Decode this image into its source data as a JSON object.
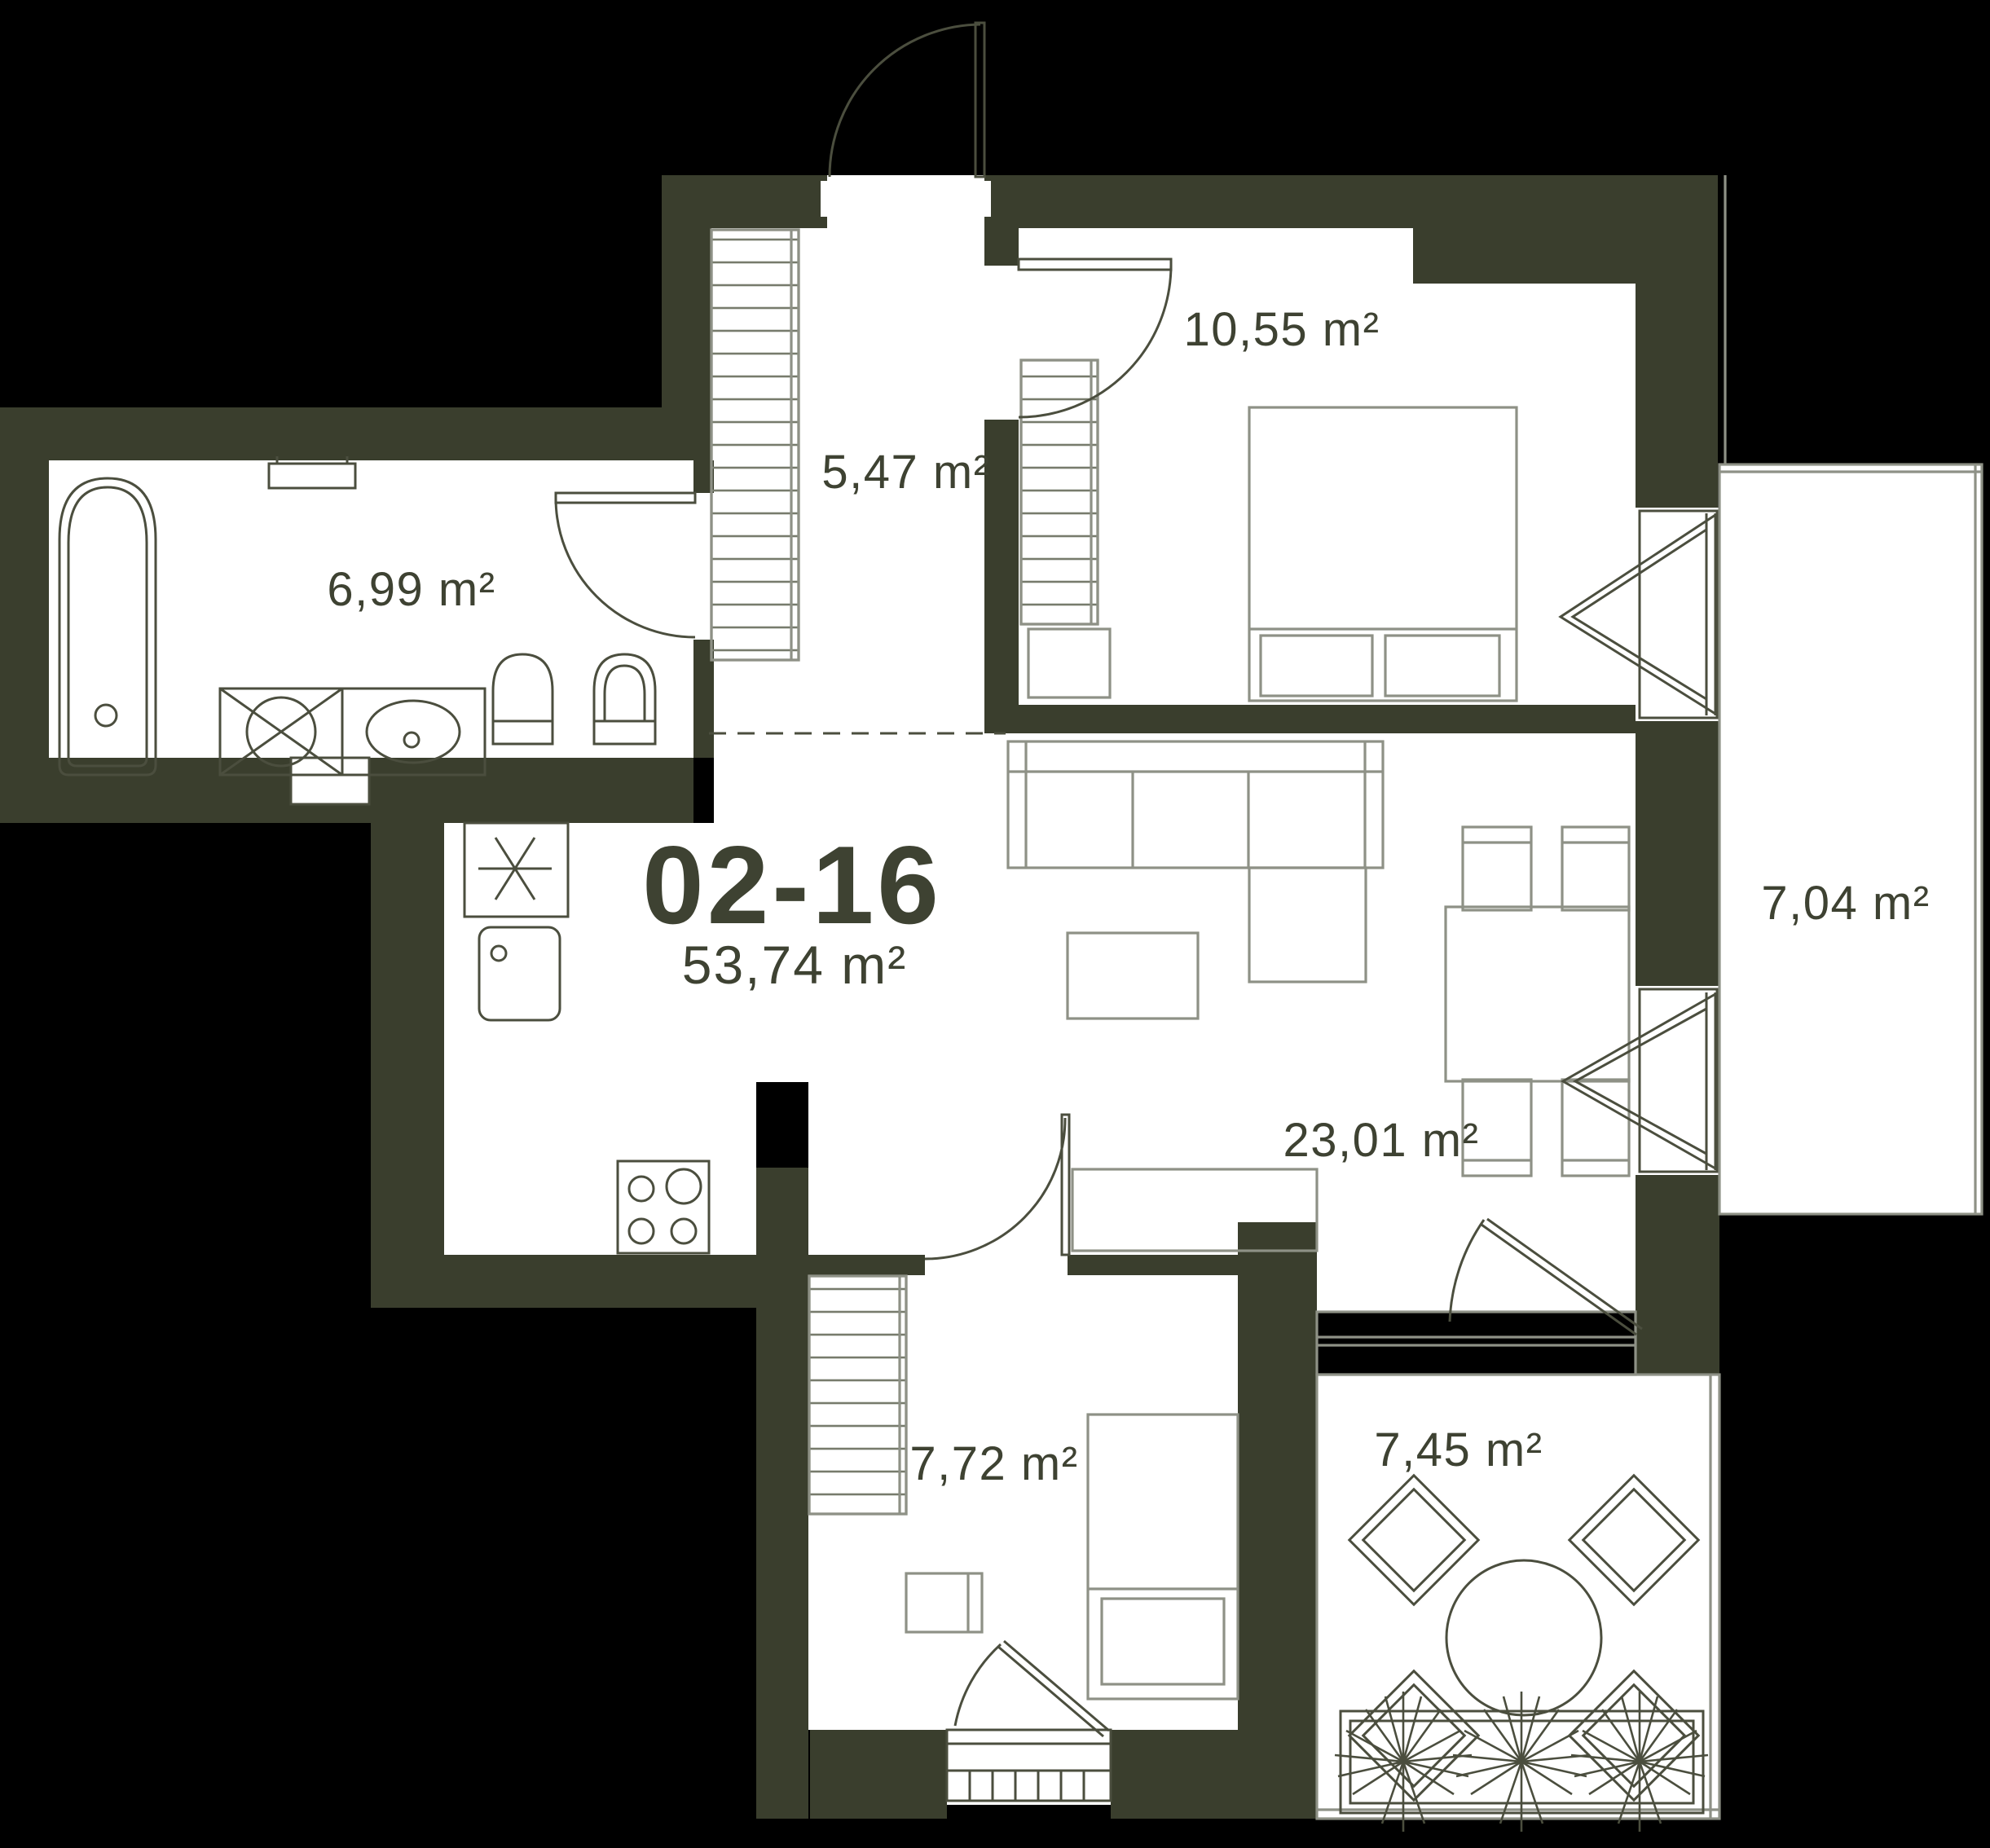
{
  "unit": {
    "number": "02-16",
    "total_area": "53,74 m²"
  },
  "rooms": [
    {
      "id": "bedroom",
      "area": "10,55 m²"
    },
    {
      "id": "hallway",
      "area": "5,47 m²"
    },
    {
      "id": "bathroom",
      "area": "6,99 m²"
    },
    {
      "id": "balcony",
      "area": "7,04 m²"
    },
    {
      "id": "living-kitchen",
      "area": "23,01 m²"
    },
    {
      "id": "kids-room",
      "area": "7,72 m²"
    },
    {
      "id": "terrace",
      "area": "7,45 m²"
    }
  ],
  "colors": {
    "background": "#000000",
    "wall": "#3A3E2D",
    "floor": "#FFFFFF",
    "line_dark": "#4B4E3E",
    "line_light": "#8E9186",
    "text": "#3E4232"
  }
}
